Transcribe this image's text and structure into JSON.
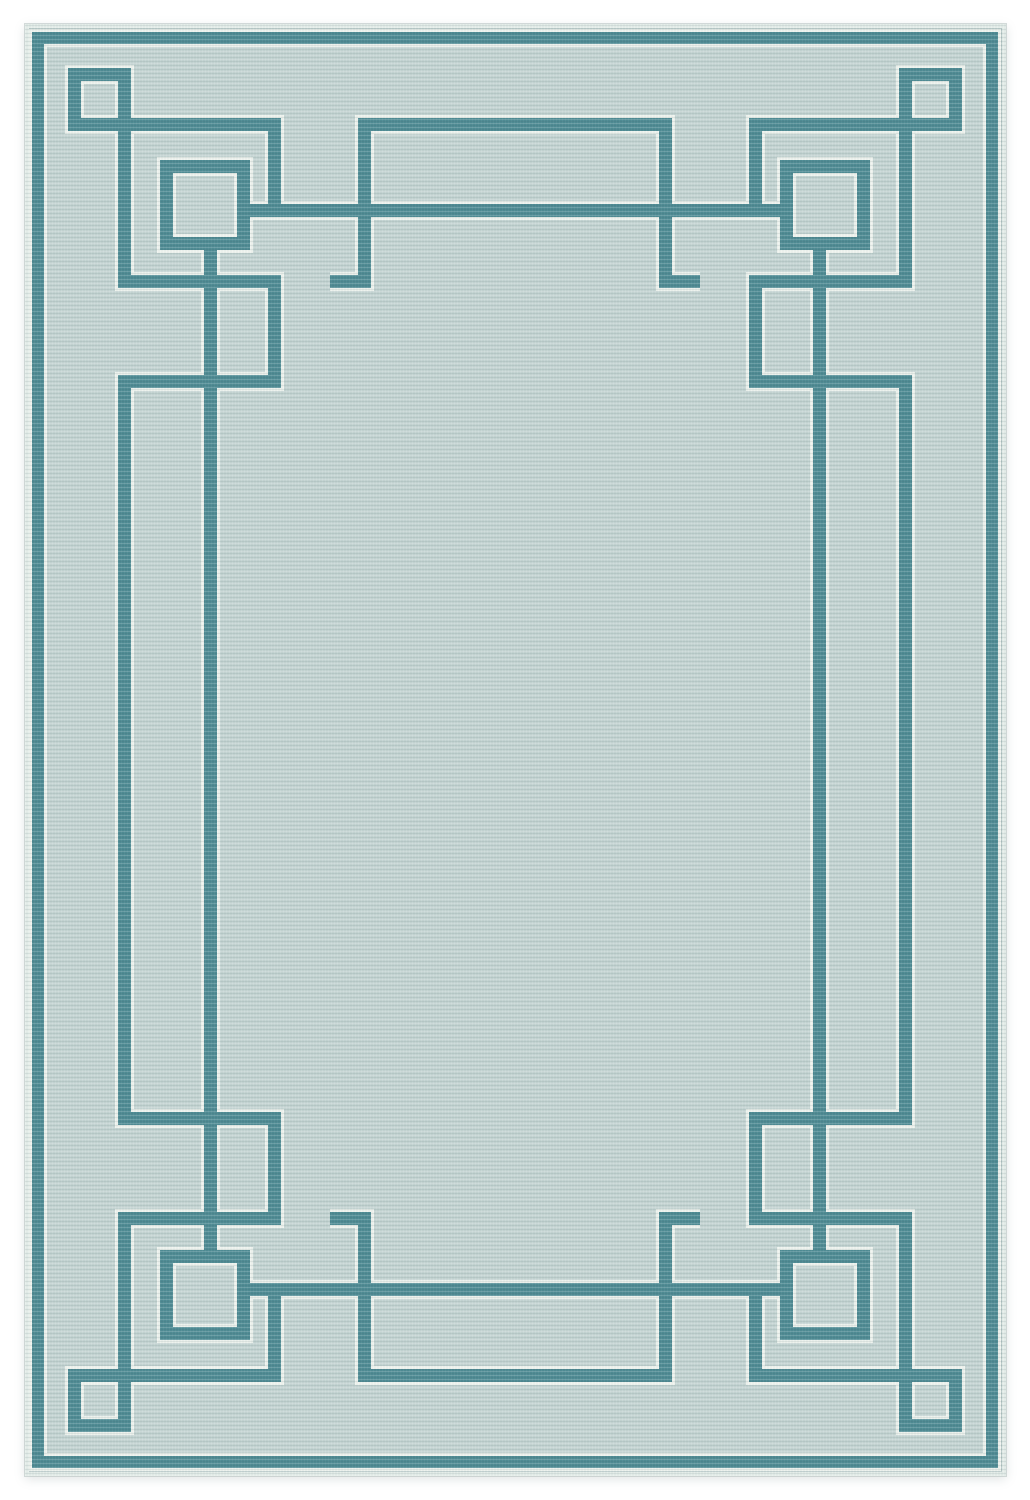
{
  "scene": {
    "type": "product-photo",
    "subject": "rectangular flat-woven area rug",
    "description": "Portrait-orientation photo of a light seafoam-blue area rug on a plain white background. The rug has an Art Deco / Greek-key style border in dark teal: an outer stripe following the rug edge, small outlined squares in each corner whose edges extend into interlocking meander arms, larger outlined squares set diagonally inward at each corner, long accent lines running parallel to each side, and rectangular tab motifs at the top and bottom center crossed by the long lines. Every teal bar is edged with thin cream outlines. The large center field is plain with a fine horizontal ribbed weave texture.",
    "background": "plain white",
    "pattern_style": "art-deco-greek-key",
    "symmetry": "four-way mirror (left-right and top-bottom)",
    "motifs": [
      "outer border stripe",
      "corner small square outline",
      "corner large square outline",
      "greek-key meander arms",
      "long accent line horizontal",
      "long accent line vertical",
      "center tab rectangle top",
      "center tab rectangle bottom",
      "cream edging on all teal bars",
      "ribbed weave texture"
    ]
  },
  "colors": {
    "photo_background": "#ffffff",
    "rug_field": "#c5d5d3",
    "pattern_teal": "#4f8b94",
    "pattern_outline": "#eef3ee",
    "edge_highlight": "#e4ede9",
    "weave_shadow": "#2f4f54"
  }
}
